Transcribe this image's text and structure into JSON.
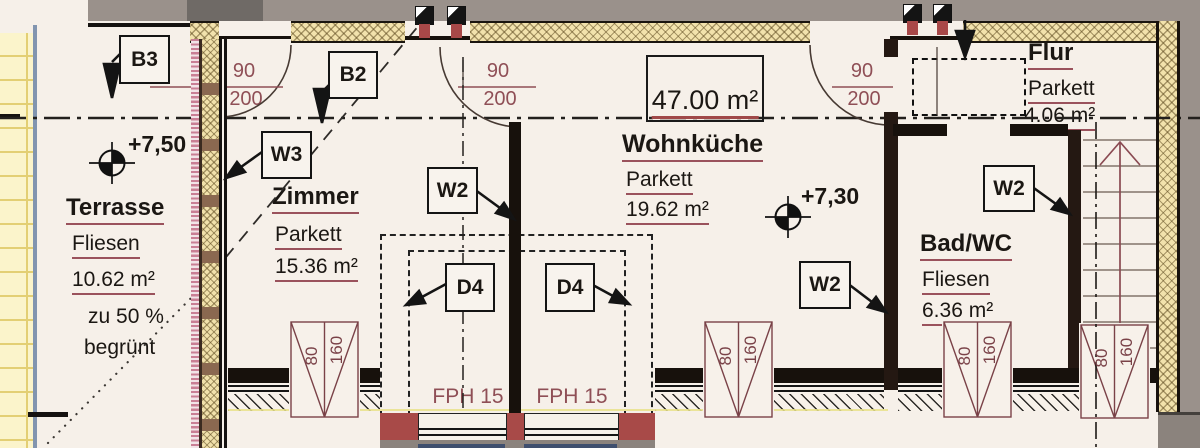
{
  "plan": {
    "rooms": [
      {
        "id": "terrasse",
        "name": "Terrasse",
        "floor": "Fliesen",
        "area": "10.62 m²",
        "notes": [
          "zu 50 %",
          "begrünt"
        ]
      },
      {
        "id": "zimmer",
        "name": "Zimmer",
        "floor": "Parkett",
        "area": "15.36 m²"
      },
      {
        "id": "wohnkueche",
        "name": "Wohnküche",
        "floor": "Parkett",
        "area": "19.62 m²"
      },
      {
        "id": "flur",
        "name": "Flur",
        "floor": "Parkett",
        "area": "4.06 m²"
      },
      {
        "id": "bad-wc",
        "name": "Bad/WC",
        "floor": "Fliesen",
        "area": "6.36 m²"
      }
    ],
    "total_area": "47.00 m²",
    "levels": [
      {
        "value": "+7,50"
      },
      {
        "value": "+7,30"
      }
    ],
    "wall_labels": {
      "b3": "B3",
      "b2": "B2",
      "w3": "W3",
      "w2": "W2",
      "d4": "D4"
    },
    "doors": [
      {
        "width": "90",
        "height": "200"
      },
      {
        "width": "90",
        "height": "200"
      },
      {
        "width": "90",
        "height": "200"
      }
    ],
    "windows": [
      {
        "width": "80",
        "height": "160"
      },
      {
        "width": "80",
        "height": "160"
      },
      {
        "width": "80",
        "height": "160"
      },
      {
        "width": "80",
        "height": "160"
      }
    ],
    "panels": [
      {
        "label": "FPH 15"
      },
      {
        "label": "FPH 15"
      }
    ],
    "colors": {
      "dim_red": "#8f4f56",
      "underline_red": "#9a525c",
      "accent_red": "#a84848",
      "insulation_yellow": "#f2e2ac",
      "outside_gray": "#9a918b",
      "terrace_edge_blue": "#8295af",
      "panel_blue": "#3f4f6e",
      "paper": "#f6f0e9"
    }
  }
}
